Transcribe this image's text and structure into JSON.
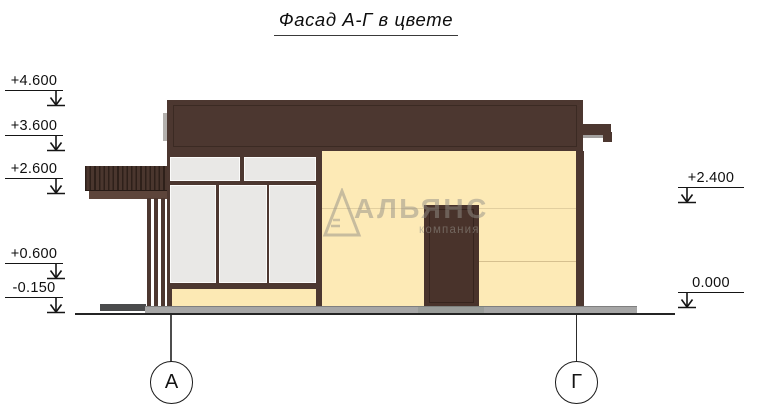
{
  "title": {
    "text": "Фасад А-Г в цвете"
  },
  "watermark": {
    "brand": "АЛЬЯНС",
    "subtitle": "компания"
  },
  "elevation_marks": {
    "left": [
      {
        "label": "+4.600"
      },
      {
        "label": "+3.600"
      },
      {
        "label": "+2.600"
      },
      {
        "label": "+0.600"
      },
      {
        "label": "-0.150"
      }
    ],
    "right": [
      {
        "label": "+2.400"
      },
      {
        "label": "0.000"
      }
    ]
  },
  "axes": {
    "left_label": "А",
    "right_label": "Г"
  },
  "colors": {
    "facade_brown": "#4c3730",
    "facade_cream": "#fdeab6",
    "glass_gray": "#e9e8e6",
    "pavement_gray": "#a6a6a6"
  }
}
